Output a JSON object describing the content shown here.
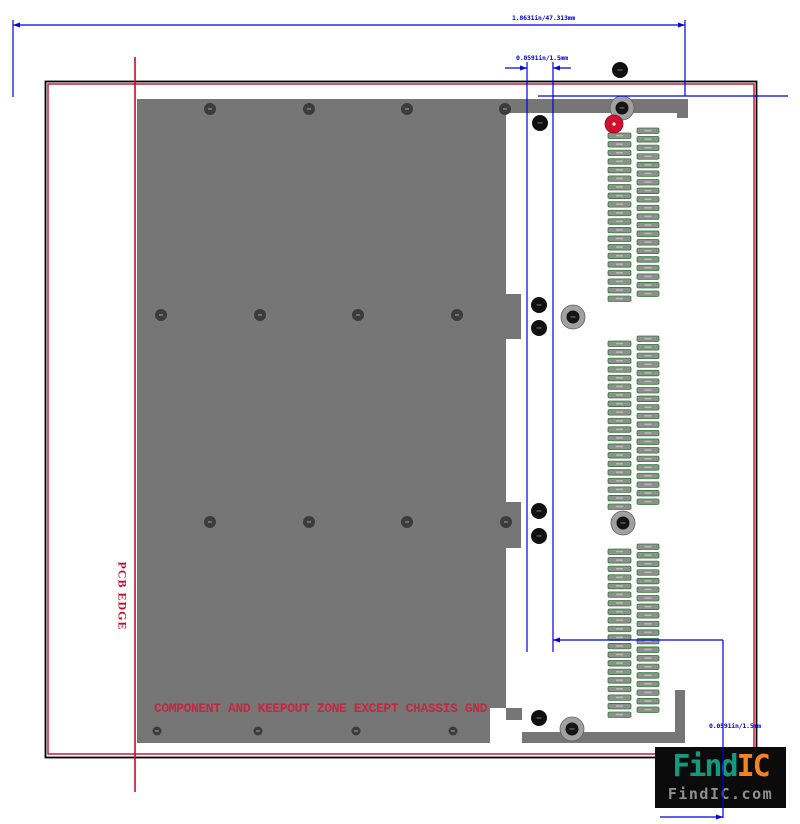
{
  "pcb_edge": {
    "label": "PCB EDGE"
  },
  "keepout": {
    "note": "COMPONENT AND KEEPOUT ZONE EXCEPT CHASSIS GND"
  },
  "dimensions": {
    "overall": {
      "label": "1.8631in/47.313mm"
    },
    "top_gap": {
      "label": "0.0591in/1.5mm"
    },
    "bottom_gap": {
      "label": "0.0591in/1.5mm"
    }
  },
  "watermark": {
    "brand_teal": "Find",
    "brand_orange": "IC",
    "domain": "FindIC.com"
  },
  "colors": {
    "dimension_blue": "#0000e0",
    "edge_red": "#c00d2d",
    "keepout_gray": "#767676",
    "keepout_text_red": "#c22840",
    "pad_gray": "#8f8f8f",
    "pad_outline_green": "#2f7d32",
    "hole_dark": "#101010",
    "ring_gray": "#a0a0a0",
    "red_pad": "#d11030",
    "logo_teal": "#13997d",
    "logo_orange": "#f5831f",
    "logo_domain_gray": "#909090",
    "border_black": "#000000"
  },
  "geometry": {
    "border_outer": {
      "x": 45.5,
      "y": 81.5,
      "w": 711,
      "h": 676
    },
    "border_inner": {
      "x": 48,
      "y": 84,
      "w": 706,
      "h": 670
    },
    "gray_rects": [
      {
        "x": 137,
        "y": 99,
        "w": 369,
        "h": 644,
        "name": "keepout-region"
      },
      {
        "x": 506,
        "y": 99,
        "w": 182,
        "h": 14,
        "name": "connector-shroud-top"
      },
      {
        "x": 677,
        "y": 113,
        "w": 11,
        "h": 5,
        "name": "connector-shroud-top-step"
      },
      {
        "x": 506,
        "y": 294,
        "w": 15,
        "h": 45,
        "name": "keying-tab-1"
      },
      {
        "x": 506,
        "y": 502,
        "w": 15,
        "h": 46,
        "name": "keying-tab-2"
      },
      {
        "x": 506,
        "y": 708,
        "w": 16,
        "h": 12,
        "name": "keying-tab-3"
      },
      {
        "x": 522,
        "y": 732,
        "w": 163,
        "h": 11,
        "name": "connector-shroud-bottom"
      },
      {
        "x": 675,
        "y": 690,
        "w": 10,
        "h": 42,
        "name": "connector-shroud-right"
      }
    ],
    "white_notch": {
      "x": 490,
      "y": 708,
      "w": 16,
      "h": 35
    },
    "pad_groups": [
      {
        "x": 608,
        "w": 23,
        "y0": 133,
        "n": 20,
        "pitch": 8.58
      },
      {
        "x": 637,
        "w": 22,
        "y0": 128,
        "n": 20,
        "pitch": 8.58
      },
      {
        "x": 608,
        "w": 23,
        "y0": 341,
        "n": 20,
        "pitch": 8.58
      },
      {
        "x": 637,
        "w": 22,
        "y0": 336,
        "n": 20,
        "pitch": 8.58
      },
      {
        "x": 608,
        "w": 23,
        "y0": 549,
        "n": 20,
        "pitch": 8.58
      },
      {
        "x": 637,
        "w": 22,
        "y0": 544,
        "n": 20,
        "pitch": 8.58
      }
    ],
    "pad_h": 5.5,
    "via_rows": [
      {
        "y": 109,
        "r": 6,
        "xs": [
          210,
          309,
          407,
          505
        ]
      },
      {
        "y": 315,
        "r": 6,
        "xs": [
          161,
          260,
          358,
          457
        ]
      },
      {
        "y": 522,
        "r": 6,
        "xs": [
          210,
          309,
          407,
          506
        ]
      },
      {
        "y": 731,
        "r": 4.5,
        "xs": [
          157,
          258,
          356,
          453
        ]
      }
    ],
    "holes": [
      [
        620,
        70
      ],
      [
        540,
        123
      ],
      [
        539,
        305
      ],
      [
        539,
        328
      ],
      [
        539,
        511
      ],
      [
        539,
        536
      ],
      [
        539,
        718
      ]
    ],
    "ring_pads": [
      [
        622,
        108
      ],
      [
        573,
        317
      ],
      [
        623,
        523
      ],
      [
        572,
        729
      ]
    ],
    "red_pad": {
      "cx": 614,
      "cy": 124,
      "r": 9
    },
    "pcb_edge_line": {
      "x": 135,
      "y1": 57,
      "y2": 792
    },
    "blue_lines": [
      {
        "x1": 13,
        "y1": 25,
        "x2": 685,
        "y2": 25,
        "a1": true,
        "a2": true
      },
      {
        "x1": 13,
        "y1": 20,
        "x2": 13,
        "y2": 97
      },
      {
        "x1": 685,
        "y1": 20,
        "x2": 685,
        "y2": 96
      },
      {
        "x1": 505,
        "y1": 68,
        "x2": 527,
        "y2": 68,
        "a2": true
      },
      {
        "x1": 553,
        "y1": 68,
        "x2": 571,
        "y2": 68,
        "a1": true
      },
      {
        "x1": 527,
        "y1": 62,
        "x2": 527,
        "y2": 652
      },
      {
        "x1": 553,
        "y1": 62,
        "x2": 553,
        "y2": 652
      },
      {
        "x1": 538,
        "y1": 96,
        "x2": 788,
        "y2": 96
      },
      {
        "x1": 553,
        "y1": 640,
        "x2": 723,
        "y2": 640,
        "a1": true
      },
      {
        "x1": 723,
        "y1": 640,
        "x2": 723,
        "y2": 818
      },
      {
        "x1": 660,
        "y1": 817,
        "x2": 723,
        "y2": 817,
        "a2": true
      }
    ]
  }
}
